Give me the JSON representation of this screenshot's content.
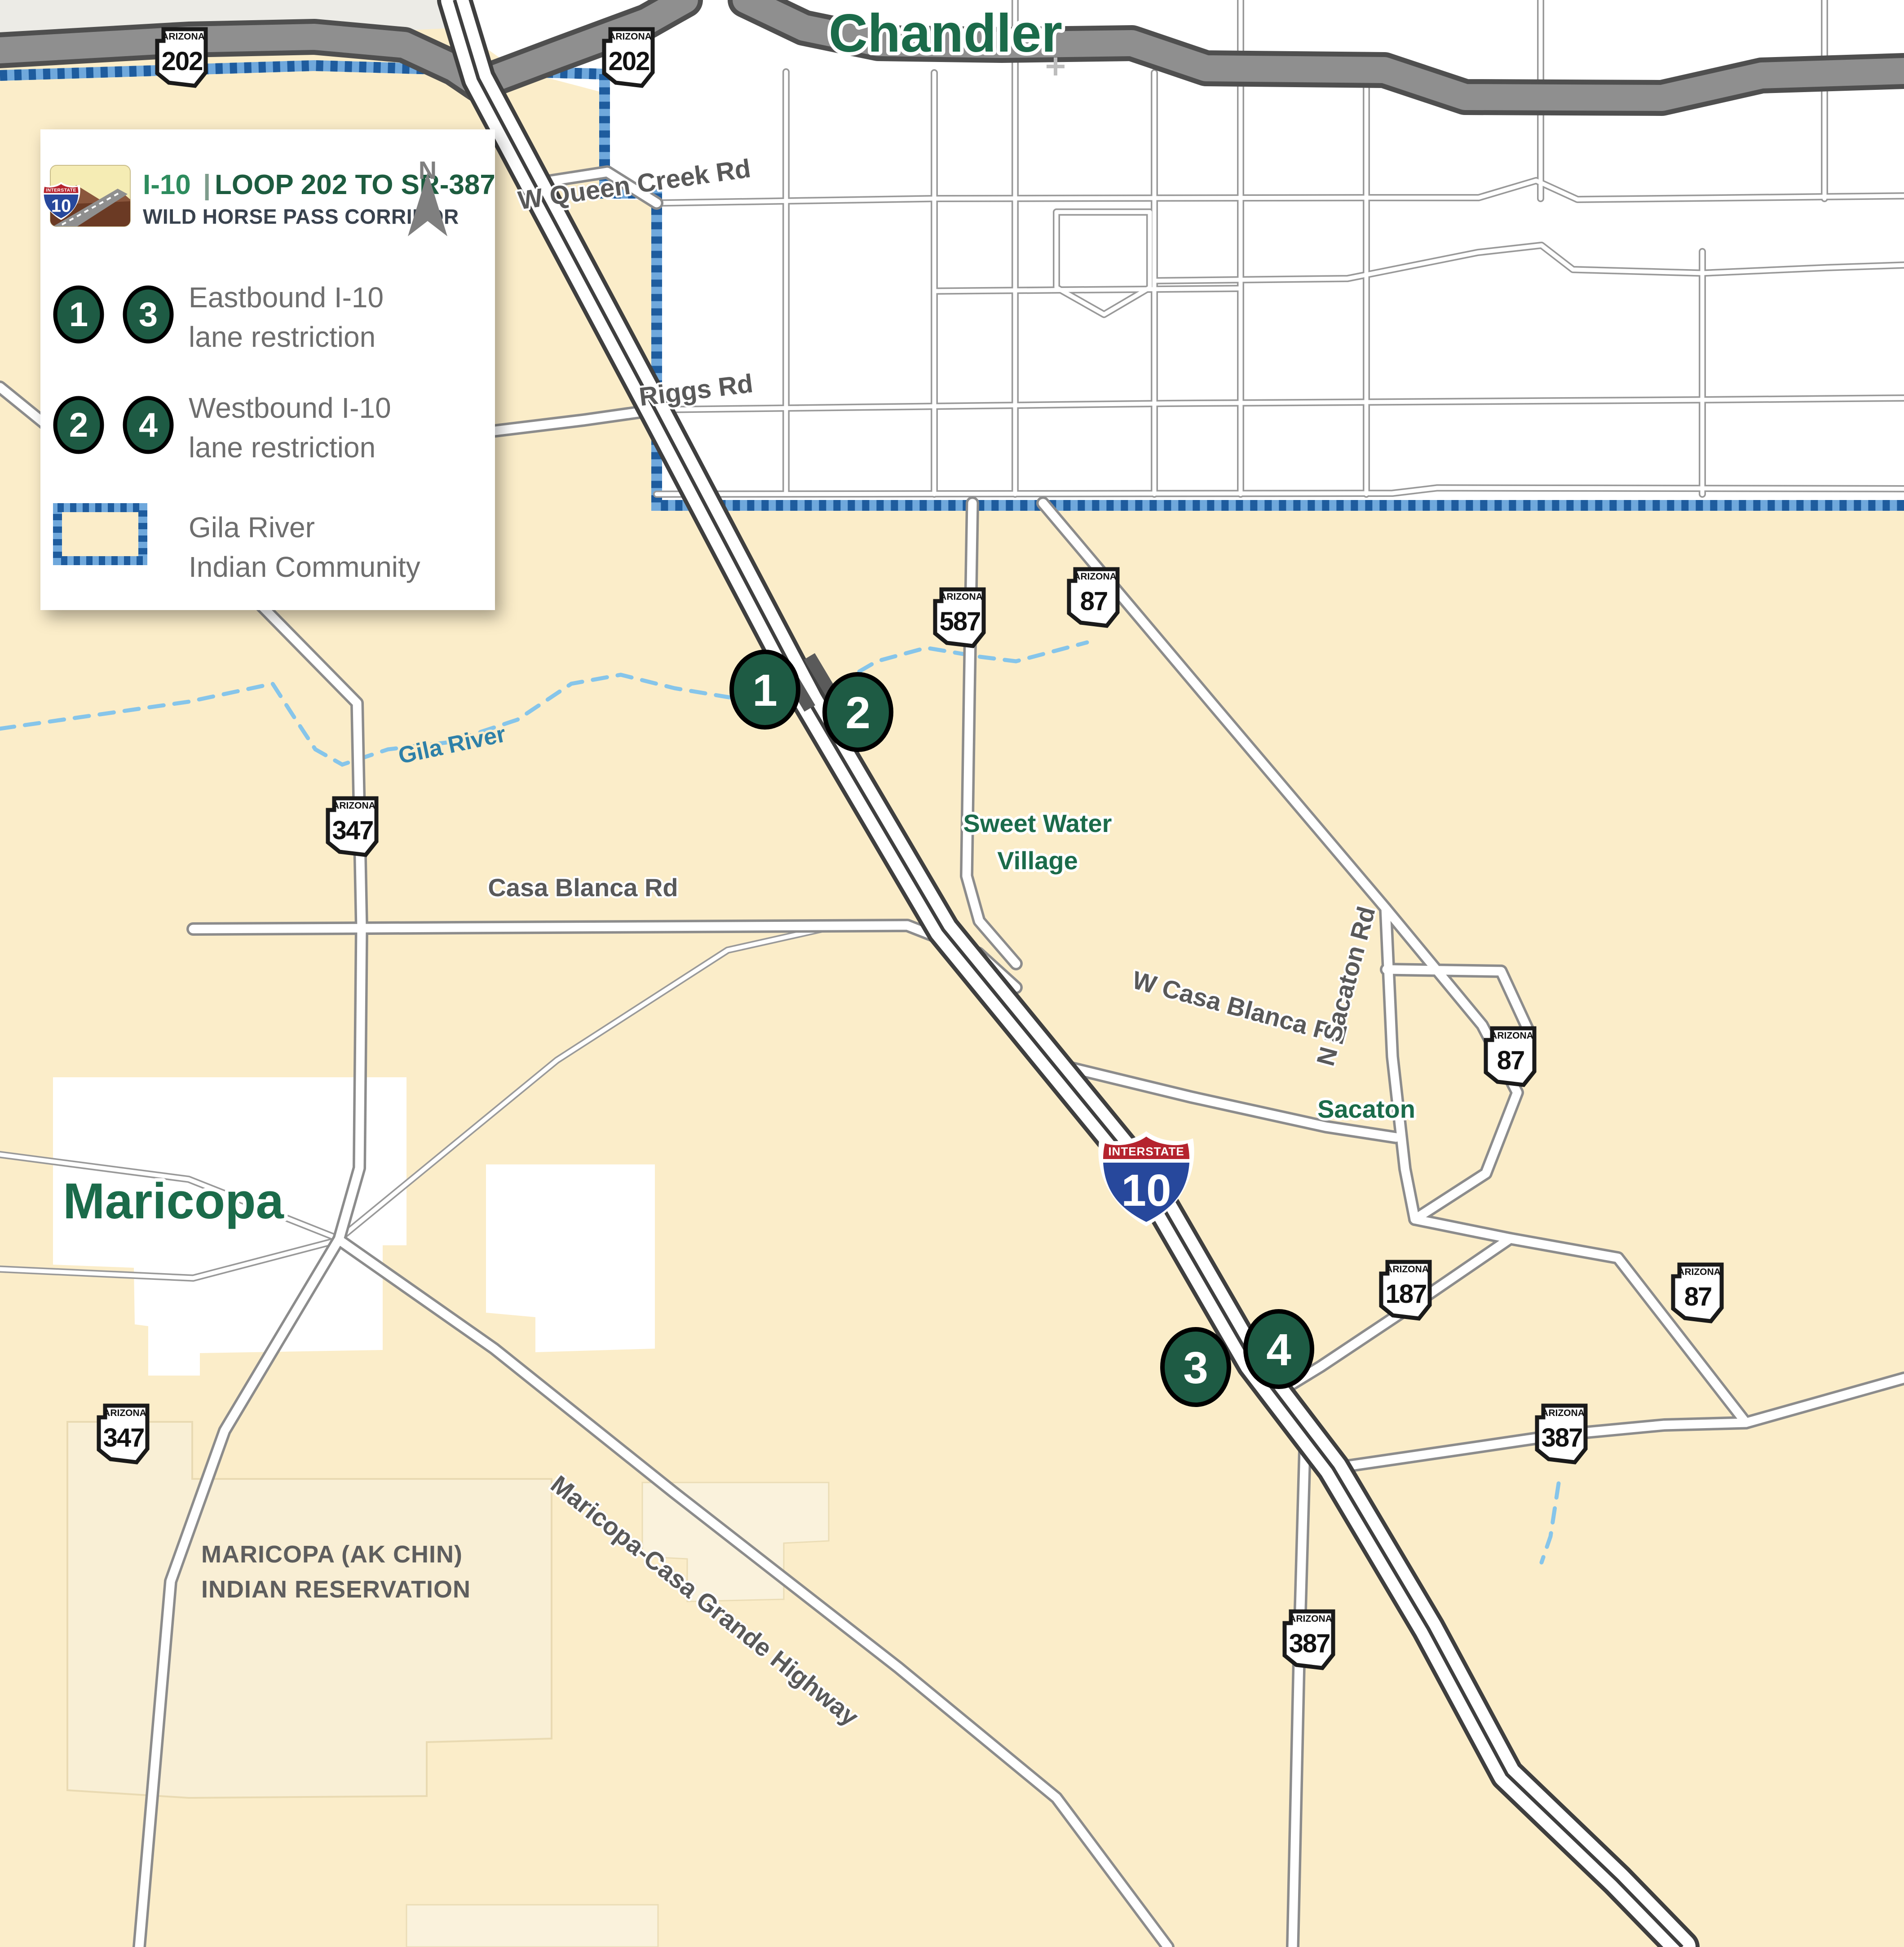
{
  "legend": {
    "card_title_road": "I-10",
    "card_title_sep": "|",
    "card_title_rest": "LOOP 202 TO SR-387",
    "card_subtitle": "WILD HORSE PASS CORRIDOR",
    "north_label": "N",
    "rows": [
      {
        "badges": [
          "1",
          "3"
        ],
        "line1": "Eastbound I-10",
        "line2": "lane restriction"
      },
      {
        "badges": [
          "2",
          "4"
        ],
        "line1": "Westbound I-10",
        "line2": "lane restriction"
      }
    ],
    "area_line1": "Gila River",
    "area_line2": "Indian Community",
    "thumb_shield_top": "INTERSTATE",
    "thumb_shield_num": "10"
  },
  "map": {
    "cities": {
      "chandler": "Chandler",
      "maricopa": "Maricopa"
    },
    "places": {
      "sweet_water_line1": "Sweet Water",
      "sweet_water_line2": "Village",
      "sacaton": "Sacaton",
      "reservation_line1": "MARICOPA (AK CHIN)",
      "reservation_line2": "INDIAN RESERVATION"
    },
    "road_labels": {
      "queen_creek": "W Queen Creek Rd",
      "riggs": "Riggs Rd",
      "casa_blanca": "Casa Blanca Rd",
      "w_casa_blanca": "W Casa Blanca Rd",
      "n_sacaton": "N Sacaton Rd",
      "mcg_highway": "Maricopa-Casa Grande Highway"
    },
    "river_label": "Gila River",
    "state_label": "ARIZONA",
    "interstate_shield": {
      "top": "INTERSTATE",
      "number": "10"
    },
    "shields": [
      {
        "id": "loop202-west",
        "number": "202"
      },
      {
        "id": "loop202-east",
        "number": "202"
      },
      {
        "id": "sr587",
        "number": "587"
      },
      {
        "id": "sr87-north",
        "number": "87"
      },
      {
        "id": "sr347-north",
        "number": "347"
      },
      {
        "id": "sr87-mid",
        "number": "87"
      },
      {
        "id": "sr187",
        "number": "187"
      },
      {
        "id": "sr87-east",
        "number": "87"
      },
      {
        "id": "sr387-east",
        "number": "387"
      },
      {
        "id": "sr347-south",
        "number": "347"
      },
      {
        "id": "sr387-south",
        "number": "387"
      }
    ],
    "markers": [
      "1",
      "2",
      "3",
      "4"
    ]
  },
  "colors": {
    "community_fill": "#FBEDC9",
    "chandler_fill": "#FFFFFF",
    "outside_fill": "#ECEBE6",
    "boundary_light": "#6FA8DC",
    "boundary_dark": "#1E5C9E",
    "marker_green": "#1E5B44",
    "city_label_green": "#1B6B4A",
    "river_blue": "#86C5EA",
    "river_label_blue": "#2E80A8",
    "road_label_gray": "#595959",
    "legend_text_gray": "#6E6E6E",
    "interstate_red": "#B5232E",
    "interstate_blue": "#27489C",
    "loop202_gray": "#8F8F8F"
  }
}
